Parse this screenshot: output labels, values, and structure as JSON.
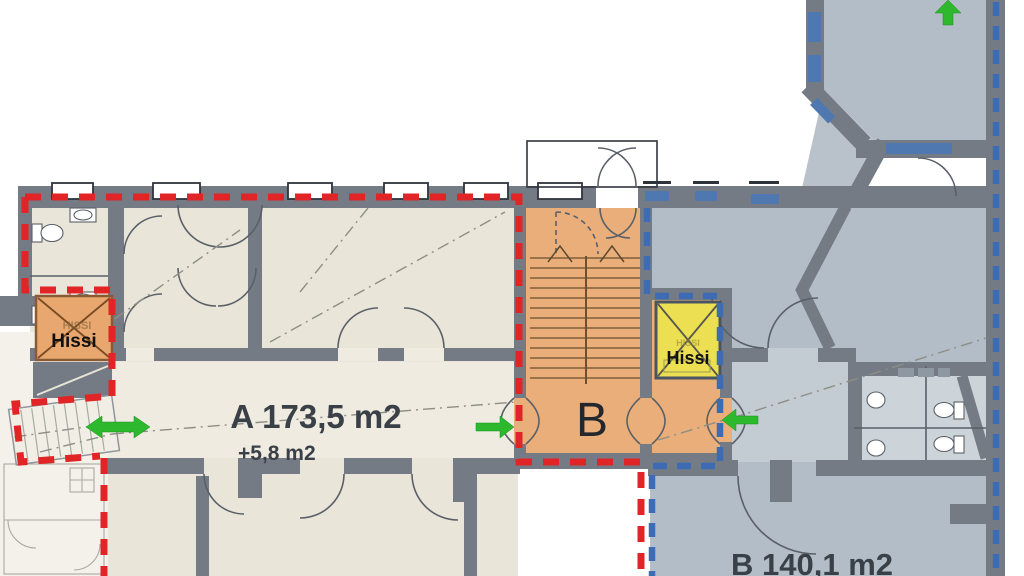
{
  "page": {
    "background": "#ffffff",
    "kind": "architectural floor plan"
  },
  "units": {
    "a": {
      "area_label": "A 173,5 m2",
      "extra_area_label": "+5,8 m2",
      "boundary_color": "#e12426"
    },
    "b": {
      "area_label": "B 140,1 m2",
      "stairwell_label": "B",
      "boundary_color": "#3d6cb4"
    }
  },
  "elevators": {
    "left": {
      "label": "Hissi",
      "ghost_label": "HISSI",
      "fill_color": "#e7a76e"
    },
    "right": {
      "label": "Hissi",
      "ghost_label": "HISSI",
      "fill_color": "#ecdf52"
    }
  },
  "arrows": {
    "color": "#2db82d",
    "items": [
      "up-arrow",
      "double-horizontal-arrow",
      "right-arrow",
      "left-arrow"
    ]
  },
  "colors": {
    "wall": "#757b84",
    "floor_unit_a": "#eae5d9",
    "corridor_a": "#efebe0",
    "floor_unit_b": "#b2bdc7",
    "corridor_b": "#c4ccd3",
    "stairwell_orange": "#e9ae79",
    "window_blue": "#4f77b0",
    "red_boundary": "#e12426",
    "blue_boundary": "#3d6cb4",
    "green_arrow": "#2db82d",
    "label_text": "#3a4047"
  }
}
